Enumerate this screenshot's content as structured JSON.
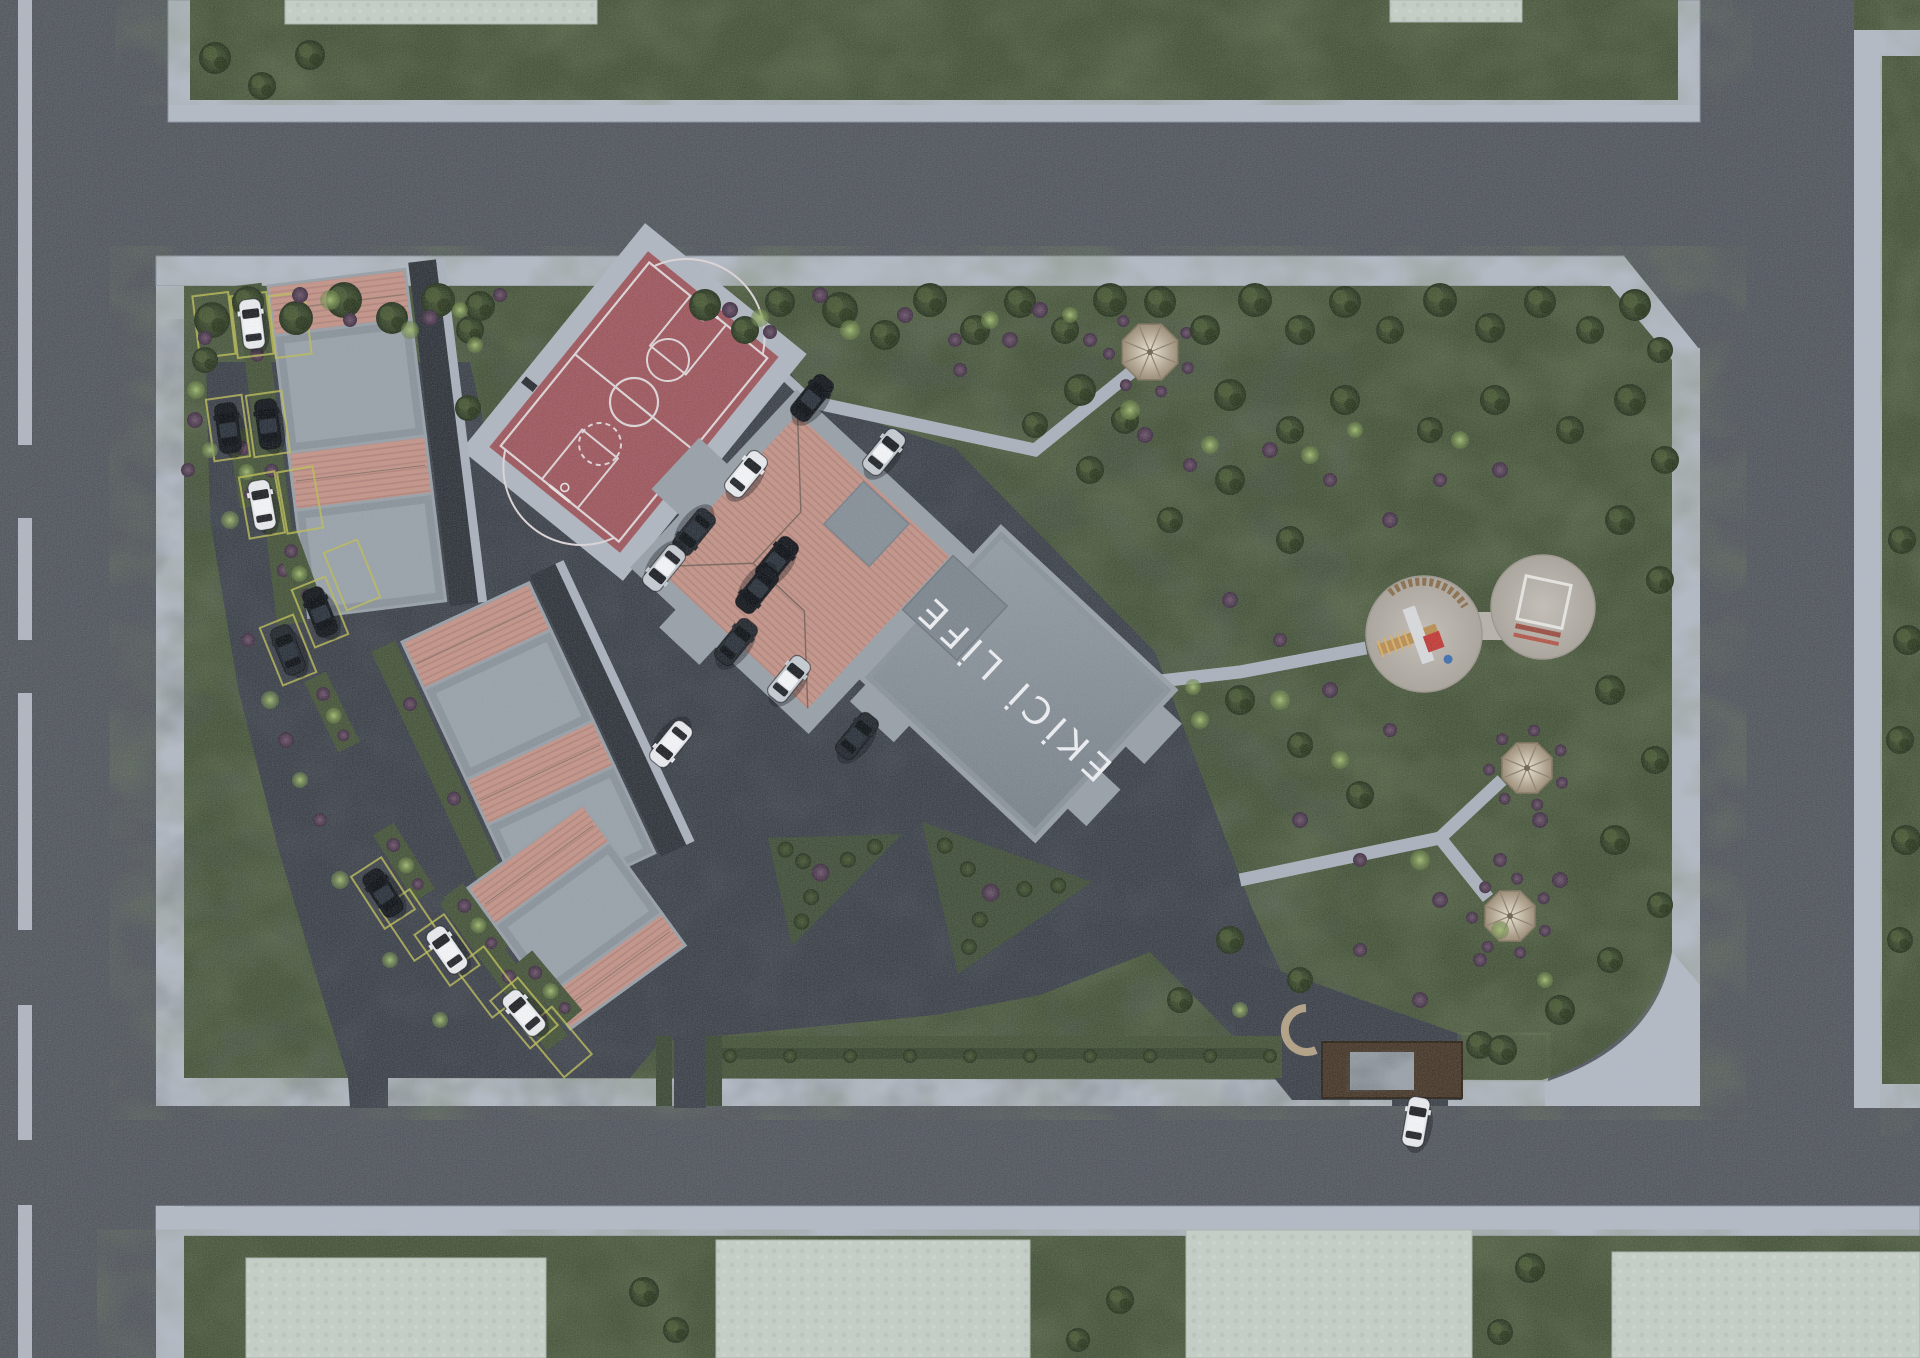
{
  "labels": {
    "building_roof_text": "EKİCİ LİFE"
  },
  "palette": {
    "road": "#53575e",
    "sidewalk": "#b4bac5",
    "curb": "#8a92a0",
    "grass": "#47553a",
    "grassDark": "#2e3a26",
    "asphalt": "#3d424a",
    "asphaltDark": "#24282e",
    "courtRed": "#9e575d",
    "courtLine": "#ded6d8",
    "roofPink": "#c49488",
    "roofStripe": "#b2837a",
    "parapet": "#98a0a8",
    "flatRoof": "#8a939b",
    "flatLight": "#99a2aa",
    "slab": "#c6cfc7",
    "wood": "#473829",
    "stone": "#9aa1a8",
    "path": "#abb2bd",
    "sand": "#b7b2ab",
    "gazeboLight": "#d8cdb9",
    "gazeboDark": "#a4957e",
    "yellow": "#bdbd55",
    "hedge": "#3a4730",
    "white_car": "#e9ebee",
    "silver_car": "#c6ccd2",
    "black_car": "#14181d",
    "dark_car": "#23282e"
  },
  "layout": {
    "canvas": [
      1920,
      1358
    ],
    "left_dashes": [
      [
        0,
        445
      ],
      [
        518,
        640
      ],
      [
        693,
        930
      ],
      [
        1005,
        1140
      ],
      [
        1205,
        1358
      ]
    ],
    "top_block": {
      "sw": [
        168,
        0,
        1532,
        122
      ],
      "green": [
        190,
        0,
        1488,
        100
      ],
      "slabs": [
        [
          285,
          0,
          312,
          24
        ],
        [
          1390,
          0,
          132,
          22
        ]
      ]
    },
    "right_block": {
      "green_top": [
        1854,
        0,
        66,
        34
      ],
      "sw_top": [
        1854,
        30,
        66,
        26
      ],
      "sw_v": [
        1854,
        30,
        28,
        1078
      ],
      "green": [
        1882,
        56,
        38,
        1028
      ],
      "sw_bot": [
        1854,
        1082,
        66,
        26
      ]
    },
    "bottom_block": {
      "sw": [
        156,
        1206,
        1764,
        30
      ],
      "sw_leg": [
        156,
        1206,
        28,
        152
      ],
      "green": [
        184,
        1236,
        1736,
        122
      ],
      "slabs": [
        [
          246,
          1258,
          300,
          100
        ],
        [
          716,
          1240,
          314,
          118
        ],
        [
          1186,
          1230,
          286,
          128
        ],
        [
          1612,
          1252,
          308,
          106
        ]
      ]
    },
    "site": {
      "sw_top": [
        156,
        256,
        1468,
        30
      ],
      "sw_chamfer": [
        [
          1624,
          256
        ],
        [
          1700,
          350
        ],
        [
          1672,
          368
        ],
        [
          1602,
          286
        ]
      ],
      "sw_right": [
        1672,
        348,
        28,
        640
      ],
      "sw_left": [
        156,
        286,
        28,
        820
      ],
      "sw_botleg": [
        184,
        1078,
        168,
        28
      ],
      "sw_bottom": [
        386,
        1078,
        1162,
        28
      ],
      "green": "M184,286 H1610 L1672,360 V950 Q1648,1046 1542,1080 L388,1078 V1078 H184 Z",
      "plaza": "M1672,952 L1700,985 L1700,1106 L1545,1106 L1545,1082 Q1656,1046 1672,952 Z"
    },
    "asphalt_lot": [
      [
        206,
        362
      ],
      [
        470,
        362
      ],
      [
        489,
        447
      ],
      [
        620,
        553
      ],
      [
        779,
        357
      ],
      [
        812,
        402
      ],
      [
        955,
        448
      ],
      [
        1155,
        652
      ],
      [
        1252,
        908
      ],
      [
        1295,
        1002
      ],
      [
        1295,
        1038
      ],
      [
        1235,
        1038
      ],
      [
        1150,
        952
      ],
      [
        1040,
        995
      ],
      [
        935,
        1015
      ],
      [
        718,
        1036
      ],
      [
        660,
        1042
      ],
      [
        630,
        1078
      ],
      [
        388,
        1078
      ],
      [
        388,
        1108
      ],
      [
        350,
        1108
      ],
      [
        348,
        1078
      ],
      [
        322,
        995
      ],
      [
        278,
        848
      ],
      [
        238,
        688
      ],
      [
        210,
        520
      ]
    ],
    "asphalt_drive": [
      [
        1235,
        955
      ],
      [
        1462,
        1035
      ],
      [
        1462,
        1100
      ],
      [
        1292,
        1100
      ],
      [
        1205,
        992
      ]
    ],
    "exit_path": [
      674,
      1036,
      32,
      72
    ],
    "gate_gap": [
      1392,
      1078,
      56,
      28
    ],
    "paths_thin": [
      [
        [
          690,
          287
        ],
        [
          812,
          402
        ]
      ]
    ],
    "paths": [
      [
        [
          812,
          402
        ],
        [
          1035,
          450
        ],
        [
          1150,
          357
        ]
      ],
      [
        [
          1080,
          690
        ],
        [
          1240,
          672
        ],
        [
          1366,
          648
        ]
      ],
      [
        [
          1240,
          880
        ],
        [
          1440,
          838
        ]
      ],
      [
        [
          1440,
          838
        ],
        [
          1502,
          780
        ]
      ],
      [
        [
          1440,
          838
        ],
        [
          1488,
          898
        ]
      ]
    ],
    "court": {
      "c": [
        634,
        402
      ],
      "size": [
        168,
        252
      ],
      "rot": 39,
      "apron": [
        208,
        292
      ]
    },
    "building": {
      "c": [
        905,
        657
      ],
      "rot": 43
    },
    "clusters": [
      {
        "t": [
          268,
          286
        ],
        "rot": -7,
        "w": 138,
        "bands": [
          50,
          118,
          58,
          108
        ],
        "lane": true
      },
      {
        "t": [
          402,
          642
        ],
        "rot": -25,
        "w": 140,
        "bands": [
          52,
          100,
          50,
          96
        ],
        "lane": true
      },
      {
        "t": [
          468,
          888
        ],
        "rot": -36,
        "w": 142,
        "bands": [
          46,
          88,
          40
        ],
        "lane": false
      }
    ],
    "hedges": {
      "tri1": [
        [
          768,
          838
        ],
        [
          902,
          834
        ],
        [
          792,
          946
        ]
      ],
      "tri2": [
        [
          922,
          822
        ],
        [
          1092,
          882
        ],
        [
          958,
          974
        ]
      ],
      "strip": [
        706,
        1036,
        576,
        42
      ],
      "exit_sides": [
        [
          656,
          1036,
          16,
          70
        ],
        [
          706,
          1036,
          16,
          70
        ]
      ],
      "strip_dots_y": 1056,
      "strip_dots_x1": 730,
      "strip_dots_x2": 1270,
      "strip_dots_n": 10
    },
    "entrance": {
      "canopy": [
        1322,
        1042,
        140,
        56
      ],
      "panel": [
        1350,
        1052,
        64,
        38
      ],
      "bench": [
        1306,
        1030
      ],
      "green_east": [
        1462,
        1035,
        84,
        44
      ]
    },
    "playground": {
      "c1": [
        1424,
        634,
        58
      ],
      "c2": [
        1543,
        607,
        52
      ],
      "link": [
        1466,
        612,
        36,
        28
      ]
    },
    "gazebos": [
      [
        1150,
        352,
        30
      ],
      [
        1527,
        768,
        27
      ],
      [
        1510,
        916,
        27
      ]
    ]
  },
  "parking_spaces": [
    [
      214,
      325,
      -7
    ],
    [
      252,
      325,
      -7
    ],
    [
      290,
      325,
      -7
    ],
    [
      228,
      428,
      -8
    ],
    [
      268,
      424,
      -8
    ],
    [
      262,
      505,
      -10
    ],
    [
      300,
      500,
      -10
    ],
    [
      320,
      612,
      -22
    ],
    [
      288,
      650,
      -22
    ],
    [
      352,
      575,
      -22
    ],
    [
      383,
      893,
      -33
    ],
    [
      447,
      950,
      -35
    ],
    [
      524,
      1013,
      -40
    ],
    [
      412,
      925,
      -34
    ],
    [
      488,
      982,
      -37
    ],
    [
      558,
      1042,
      -40
    ]
  ],
  "dividers": [
    [
      246,
      468,
      -9
    ],
    [
      298,
      570,
      -20
    ],
    [
      332,
      712,
      -26
    ],
    [
      404,
      862,
      -32
    ],
    [
      476,
      922,
      -36
    ],
    [
      548,
      988,
      -40
    ]
  ],
  "cars": [
    [
      252,
      324,
      -7,
      "white_car"
    ],
    [
      228,
      428,
      -8,
      "black_car"
    ],
    [
      268,
      424,
      -8,
      "black_car"
    ],
    [
      262,
      505,
      -10,
      "white_car"
    ],
    [
      320,
      612,
      -22,
      "black_car"
    ],
    [
      288,
      650,
      -22,
      "dark_car"
    ],
    [
      383,
      893,
      -33,
      "black_car"
    ],
    [
      447,
      950,
      -35,
      "white_car"
    ],
    [
      524,
      1013,
      -40,
      "white_car"
    ],
    [
      812,
      398,
      39,
      "black_car"
    ],
    [
      884,
      452,
      39,
      "silver_car"
    ],
    [
      746,
      474,
      39,
      "white_car"
    ],
    [
      694,
      532,
      219,
      "dark_car"
    ],
    [
      664,
      568,
      219,
      "silver_car"
    ],
    [
      777,
      560,
      39,
      "black_car"
    ],
    [
      757,
      590,
      219,
      "black_car"
    ],
    [
      736,
      642,
      39,
      "dark_car"
    ],
    [
      789,
      679,
      39,
      "silver_car"
    ],
    [
      857,
      736,
      39,
      "dark_car"
    ],
    [
      671,
      744,
      219,
      "white_car"
    ],
    [
      1416,
      1122,
      10,
      "white_car"
    ]
  ],
  "trees": [
    [
      212,
      320,
      18
    ],
    [
      248,
      302,
      16
    ],
    [
      296,
      318,
      17
    ],
    [
      344,
      300,
      18
    ],
    [
      392,
      318,
      16
    ],
    [
      438,
      300,
      17
    ],
    [
      470,
      330,
      14
    ],
    [
      205,
      360,
      13
    ],
    [
      480,
      306,
      15
    ],
    [
      468,
      408,
      13
    ],
    [
      705,
      305,
      16
    ],
    [
      745,
      330,
      14
    ],
    [
      780,
      302,
      15
    ],
    [
      840,
      310,
      18
    ],
    [
      885,
      335,
      15
    ],
    [
      930,
      300,
      17
    ],
    [
      975,
      330,
      15
    ],
    [
      1020,
      302,
      16
    ],
    [
      1065,
      330,
      14
    ],
    [
      1110,
      300,
      17
    ],
    [
      1160,
      302,
      16
    ],
    [
      1205,
      330,
      15
    ],
    [
      1255,
      300,
      17
    ],
    [
      1300,
      330,
      15
    ],
    [
      1345,
      302,
      16
    ],
    [
      1390,
      330,
      14
    ],
    [
      1440,
      300,
      17
    ],
    [
      1490,
      328,
      15
    ],
    [
      1540,
      302,
      16
    ],
    [
      1590,
      330,
      14
    ],
    [
      1635,
      305,
      16
    ],
    [
      1660,
      350,
      13
    ],
    [
      1080,
      390,
      16
    ],
    [
      1035,
      425,
      13
    ],
    [
      1125,
      420,
      14
    ],
    [
      1230,
      395,
      16
    ],
    [
      1290,
      430,
      14
    ],
    [
      1345,
      400,
      15
    ],
    [
      1430,
      430,
      13
    ],
    [
      1495,
      400,
      15
    ],
    [
      1570,
      430,
      14
    ],
    [
      1630,
      400,
      16
    ],
    [
      1665,
      460,
      14
    ],
    [
      1620,
      520,
      15
    ],
    [
      1660,
      580,
      14
    ],
    [
      1230,
      480,
      15
    ],
    [
      1170,
      520,
      13
    ],
    [
      1290,
      540,
      14
    ],
    [
      1090,
      470,
      14
    ],
    [
      1240,
      700,
      15
    ],
    [
      1300,
      745,
      13
    ],
    [
      1360,
      795,
      14
    ],
    [
      1610,
      690,
      15
    ],
    [
      1655,
      760,
      14
    ],
    [
      1615,
      840,
      15
    ],
    [
      1660,
      905,
      13
    ],
    [
      1560,
      1010,
      15
    ],
    [
      1610,
      960,
      13
    ],
    [
      1480,
      1045,
      14
    ],
    [
      1300,
      980,
      13
    ],
    [
      1230,
      940,
      14
    ],
    [
      1180,
      1000,
      13
    ],
    [
      1502,
      1050,
      15
    ],
    [
      215,
      58,
      16
    ],
    [
      262,
      86,
      14
    ],
    [
      310,
      55,
      15
    ],
    [
      1902,
      540,
      14
    ],
    [
      1908,
      640,
      15
    ],
    [
      1900,
      740,
      14
    ],
    [
      1906,
      840,
      15
    ],
    [
      1900,
      940,
      13
    ],
    [
      644,
      1292,
      15
    ],
    [
      676,
      1330,
      13
    ],
    [
      1120,
      1300,
      14
    ],
    [
      1530,
      1268,
      15
    ],
    [
      1500,
      1332,
      13
    ],
    [
      1078,
      1340,
      12
    ]
  ],
  "shrubs": [
    [
      330,
      300,
      10
    ],
    [
      410,
      330,
      9
    ],
    [
      460,
      310,
      8
    ],
    [
      475,
      345,
      8
    ],
    [
      760,
      318,
      9
    ],
    [
      850,
      330,
      10
    ],
    [
      990,
      320,
      9
    ],
    [
      1070,
      315,
      8
    ],
    [
      1130,
      410,
      10
    ],
    [
      1210,
      445,
      9
    ],
    [
      1310,
      455,
      9
    ],
    [
      1355,
      430,
      8
    ],
    [
      1460,
      440,
      9
    ],
    [
      1280,
      700,
      10
    ],
    [
      1340,
      760,
      9
    ],
    [
      1420,
      860,
      10
    ],
    [
      1500,
      930,
      9
    ],
    [
      1545,
      980,
      8
    ],
    [
      1200,
      720,
      9
    ],
    [
      196,
      390,
      9
    ],
    [
      210,
      450,
      8
    ],
    [
      230,
      520,
      9
    ],
    [
      270,
      700,
      9
    ],
    [
      300,
      780,
      8
    ],
    [
      340,
      880,
      9
    ],
    [
      390,
      960,
      8
    ],
    [
      440,
      1020,
      8
    ],
    [
      1193,
      687,
      8
    ],
    [
      1240,
      1010,
      8
    ]
  ],
  "purple_bushes": [
    [
      300,
      295,
      8
    ],
    [
      350,
      320,
      7
    ],
    [
      430,
      318,
      8
    ],
    [
      500,
      295,
      7
    ],
    [
      730,
      310,
      8
    ],
    [
      770,
      332,
      7
    ],
    [
      820,
      295,
      8
    ],
    [
      905,
      315,
      8
    ],
    [
      955,
      340,
      7
    ],
    [
      1040,
      310,
      8
    ],
    [
      1090,
      340,
      7
    ],
    [
      1145,
      435,
      8
    ],
    [
      1190,
      465,
      7
    ],
    [
      1270,
      450,
      8
    ],
    [
      1330,
      480,
      7
    ],
    [
      1390,
      520,
      8
    ],
    [
      1440,
      480,
      7
    ],
    [
      1500,
      470,
      8
    ],
    [
      1230,
      600,
      8
    ],
    [
      1280,
      640,
      7
    ],
    [
      1330,
      690,
      8
    ],
    [
      1390,
      730,
      7
    ],
    [
      1300,
      820,
      8
    ],
    [
      1360,
      860,
      7
    ],
    [
      1440,
      900,
      8
    ],
    [
      1500,
      860,
      7
    ],
    [
      1540,
      820,
      8
    ],
    [
      1480,
      960,
      7
    ],
    [
      1420,
      1000,
      8
    ],
    [
      1360,
      950,
      7
    ],
    [
      1560,
      880,
      8
    ],
    [
      960,
      370,
      7
    ],
    [
      1010,
      340,
      8
    ],
    [
      205,
      338,
      7
    ],
    [
      195,
      420,
      8
    ],
    [
      188,
      470,
      7
    ],
    [
      248,
      640,
      7
    ],
    [
      286,
      740,
      8
    ],
    [
      320,
      820,
      7
    ]
  ]
}
